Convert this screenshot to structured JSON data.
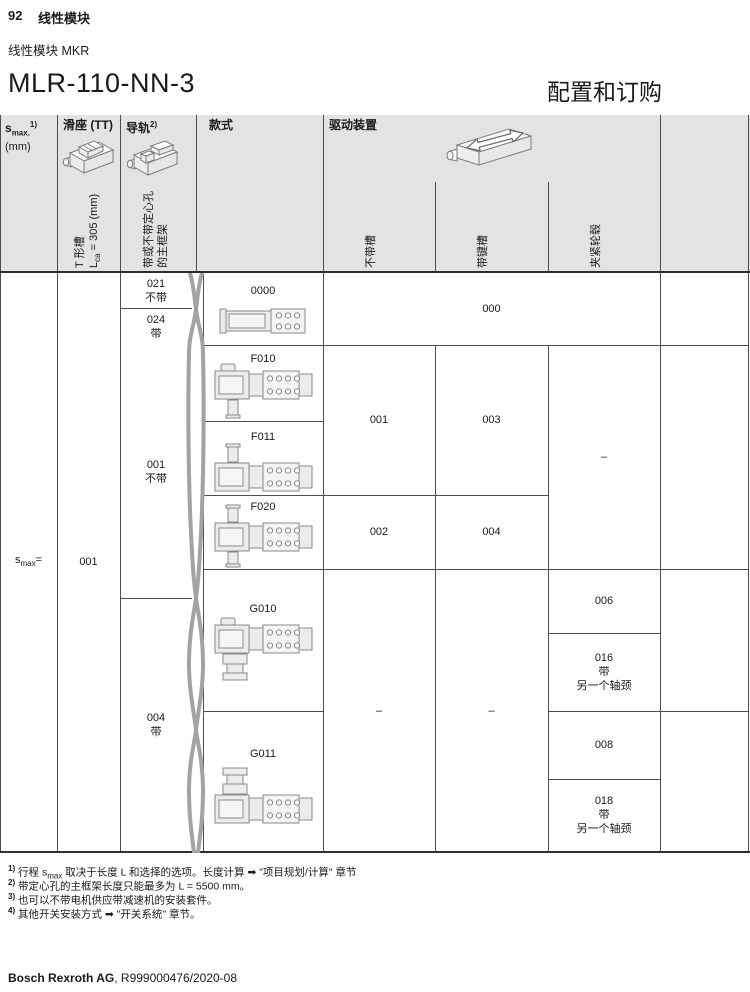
{
  "page": {
    "page_number": "92",
    "chapter": "线性模块",
    "product_line": "线性模块 MKR",
    "title": "MLR-110-NN-3",
    "title_right": "配置和订购"
  },
  "colors": {
    "header_bg": "#e3e3e3",
    "grid_line": "#4d4d4d",
    "strong_line": "#2e2e2e",
    "tear_mark": "#a3a3a3",
    "drawing_stroke": "#8a8a8a",
    "drawing_fill": "#ececec"
  },
  "icons": {
    "carriage": "carriage-isometric-icon",
    "rail": "rail-isometric-icon",
    "drive": "drive-arrow-isometric-icon"
  },
  "table": {
    "header": {
      "smax": {
        "base": "s",
        "sub": "max.",
        "sup": "1)",
        "unit": "(mm)"
      },
      "carriage": {
        "title": "滑座 (TT)",
        "vline1": "T 形槽",
        "vline2_base": "L",
        "vline2_sub": "ca",
        "vline2_rest": " = 305 (mm)"
      },
      "rail": {
        "title": "导轨",
        "sup": "2)",
        "vline1": "带或不带定心孔",
        "vline2": "的主框架"
      },
      "style": {
        "title": "款式"
      },
      "drive": {
        "title": "驱动装置",
        "sub_columns": [
          "不带槽",
          "带键槽",
          "夹紧轮毂"
        ]
      }
    },
    "body": {
      "smax_cell": {
        "base": "s",
        "sub": "max",
        "rest": "="
      },
      "carriage_value": "001",
      "rail_cells": [
        {
          "code": "021",
          "note": "不带"
        },
        {
          "code": "024",
          "note": "带"
        },
        {
          "code": "001",
          "note": "不带"
        },
        {
          "code": "004",
          "note": "带"
        }
      ],
      "style_cells": [
        "0000",
        "F010",
        "F011",
        "F020",
        "G010",
        "G011"
      ],
      "drive_cells": {
        "row_0000_merged": "000",
        "f010_f011_no_groove": "001",
        "f010_f011_keyway": "003",
        "f020_no_groove": "002",
        "f020_keyway": "004",
        "f_clamping_hub": "–",
        "g_no_groove": "–",
        "g_keyway": "–",
        "g010_clamping_hub": "006",
        "g010_clamping_hub_alt": "016\n带\n另一个轴颈",
        "g011_clamping_hub": "008",
        "g011_clamping_hub_alt": "018\n带\n另一个轴颈"
      }
    }
  },
  "footnotes": [
    {
      "sup": "1)",
      "pre": "行程 s",
      "sub": "max",
      "post": " 取决于长度 L 和选择的选项。长度计算 ➡ \"项目规划/计算\" 章节"
    },
    {
      "sup": "2)",
      "pre": "带定心孔的主框架长度只能最多为 L = 5500 mm。",
      "sub": "",
      "post": ""
    },
    {
      "sup": "3)",
      "pre": "也可以不带电机供应带减速机的安装套件。",
      "sub": "",
      "post": ""
    },
    {
      "sup": "4)",
      "pre": "其他开关安装方式 ➡ \"开关系统\" 章节。",
      "sub": "",
      "post": ""
    }
  ],
  "footer": {
    "company": "Bosch Rexroth AG",
    "document": ", R999000476/2020-08"
  }
}
